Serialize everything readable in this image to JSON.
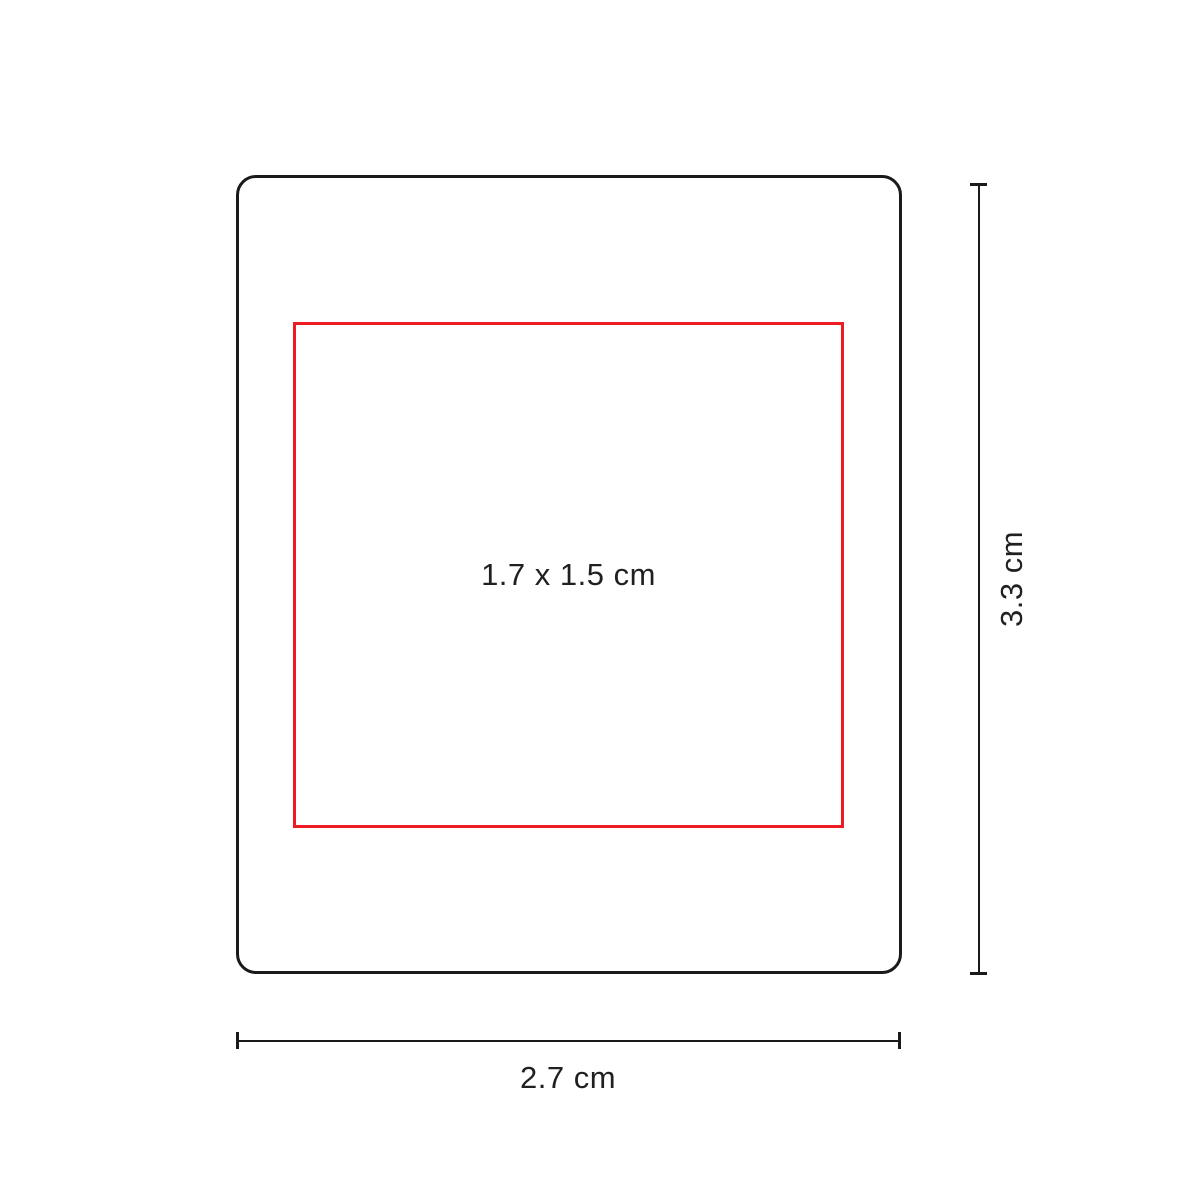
{
  "diagram": {
    "type": "imprint-area-dimension-diagram",
    "print_area": {
      "label": "1.7 x 1.5 cm",
      "width_cm": 1.7,
      "height_cm": 1.5
    },
    "width": {
      "label": "2.7 cm",
      "value_cm": 2.7
    },
    "height": {
      "label": "3.3 cm",
      "value_cm": 3.3
    },
    "colors": {
      "outline": "#1a1a1a",
      "print_area": "#ed1c24",
      "text": "#221f20",
      "background": "#ffffff"
    }
  }
}
